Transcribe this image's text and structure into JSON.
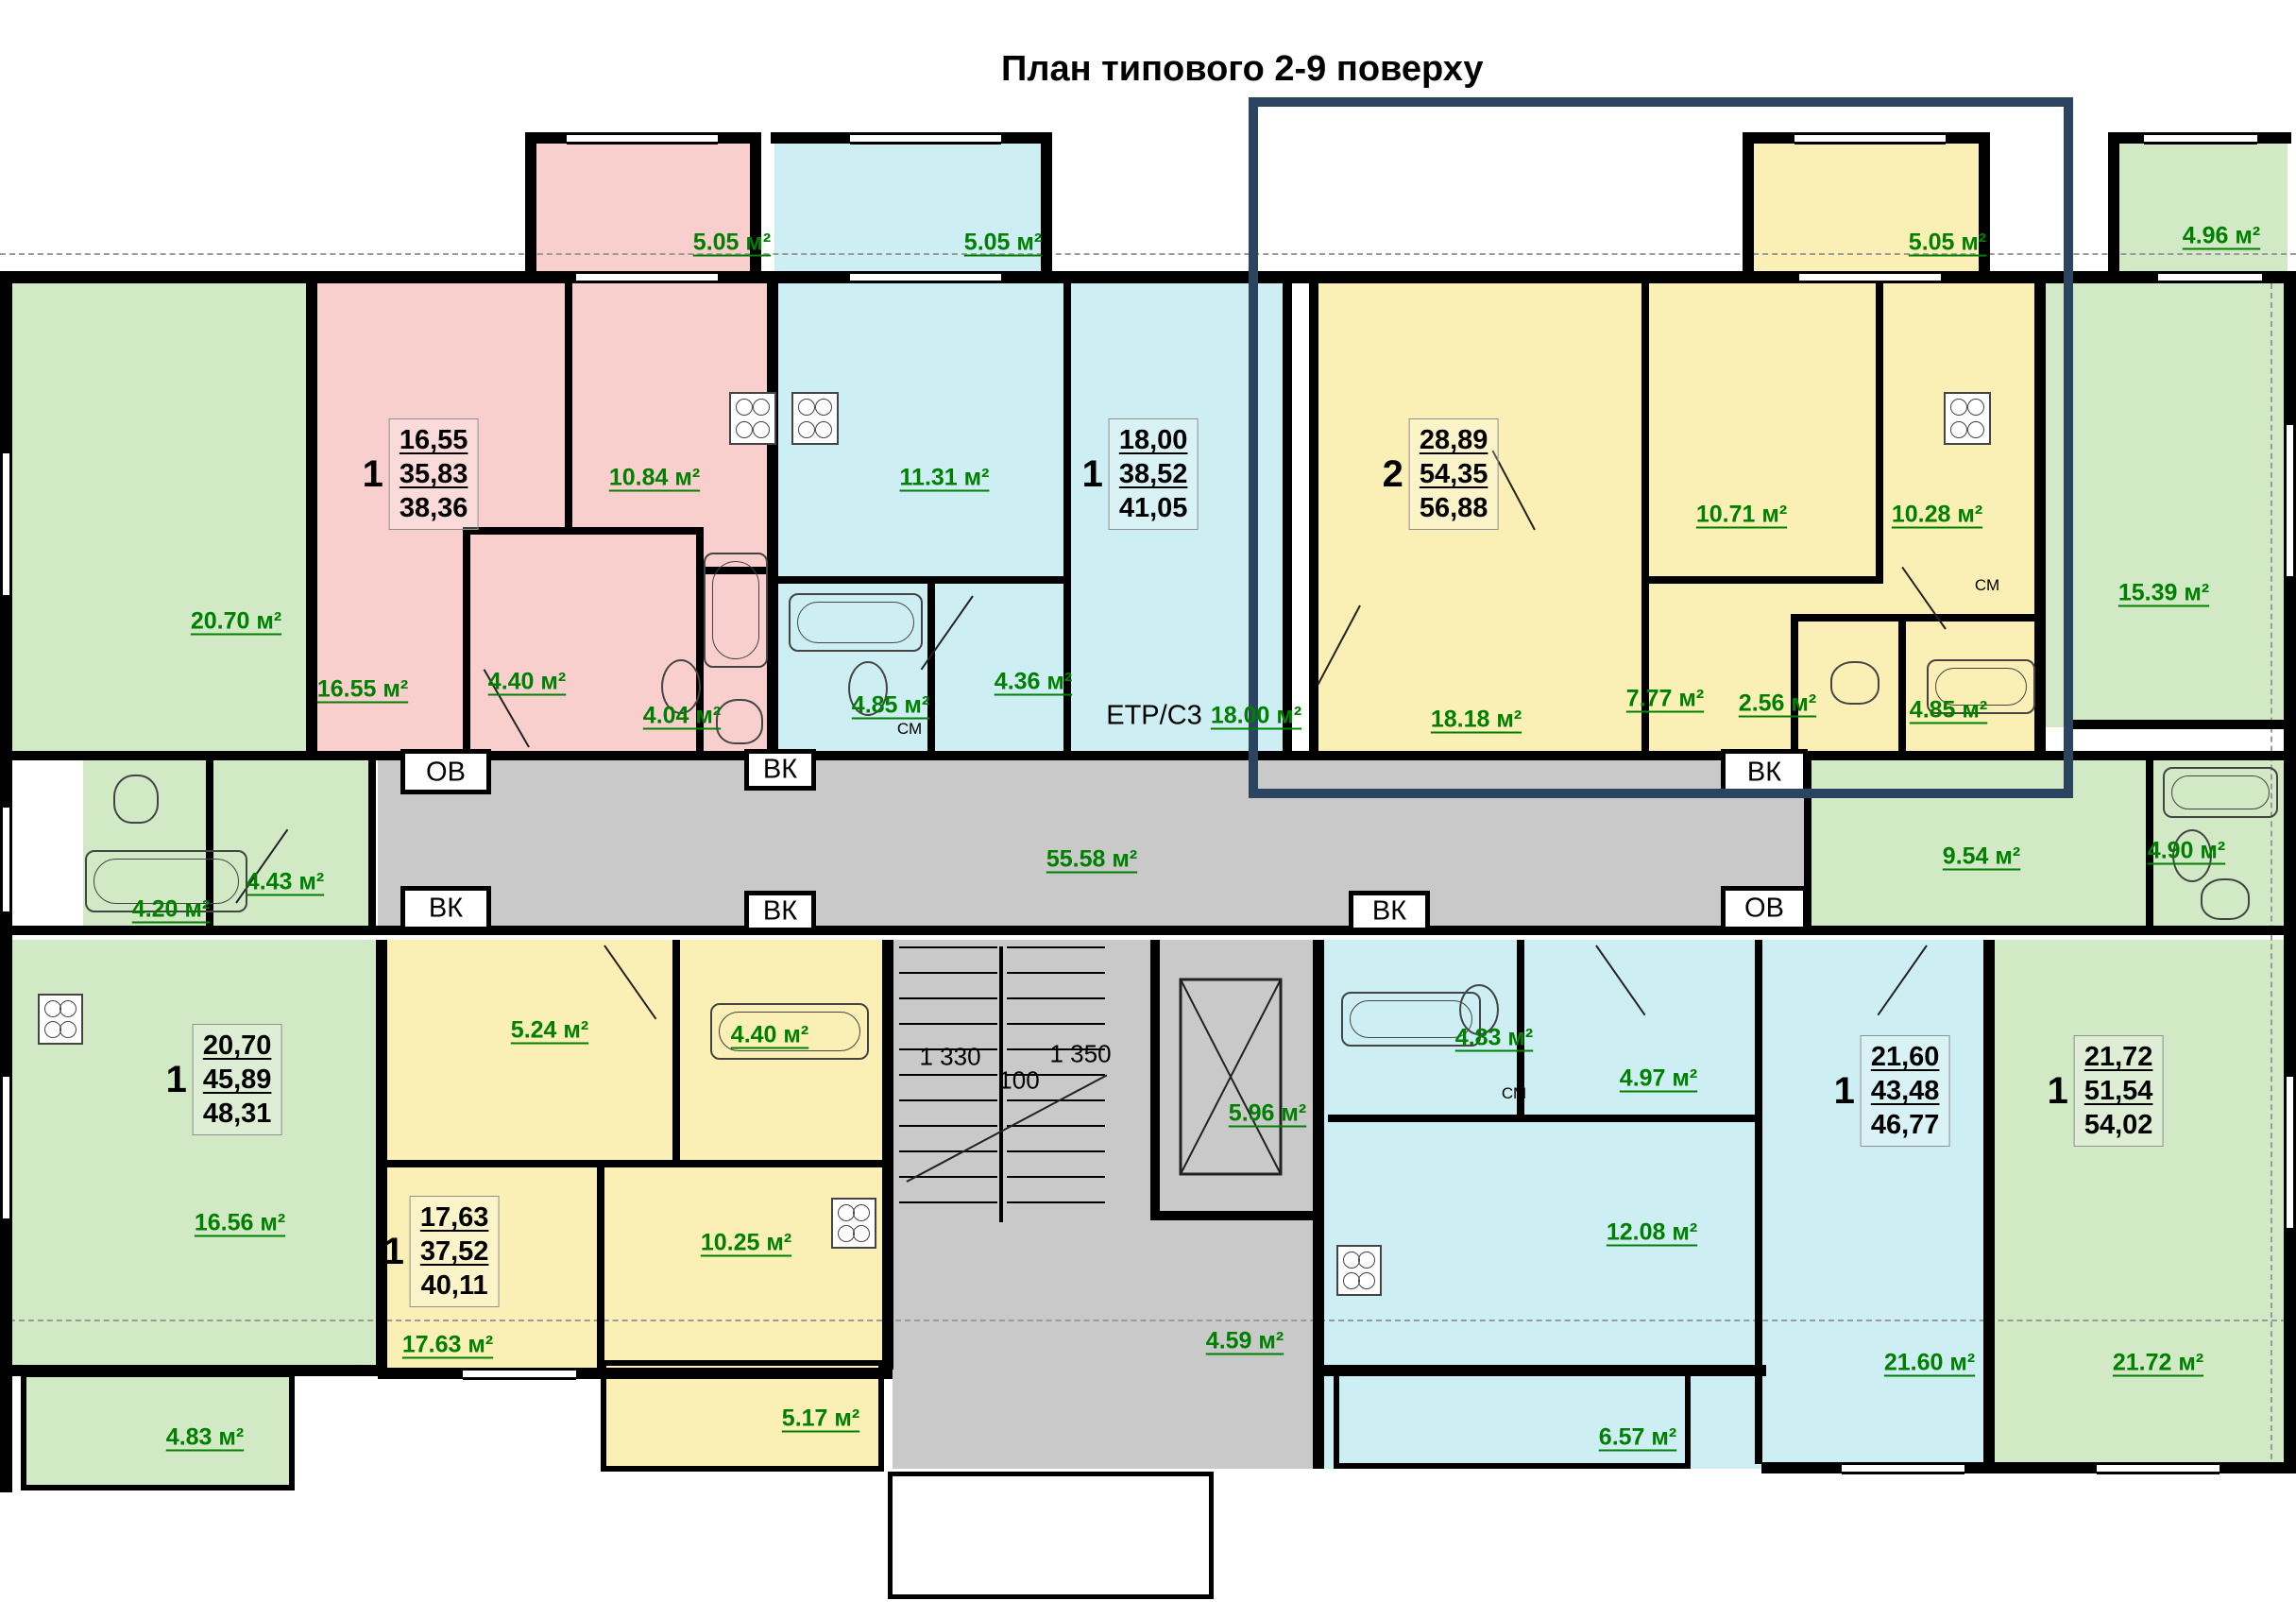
{
  "title": "План типового 2-9 поверху",
  "service": {
    "ov": "ОВ",
    "vk": "ВК",
    "sm": "СМ",
    "etr": "ЕТР/С3"
  },
  "dims": {
    "flight_left": "1 330",
    "flight_right": "1 350",
    "gap": "100"
  },
  "areas": {
    "balcony_pink": "5.05 м²",
    "balcony_blue": "5.05 м²",
    "balcony_yellow": "5.05 м²",
    "balcony_green": "4.96 м²",
    "green_tl_room": "20.70 м²",
    "pink_living": "16.55 м²",
    "pink_kitchen": "10.84 м²",
    "pink_hall": "4.40 м²",
    "pink_bath": "4.04 м²",
    "blue_kitchen": "11.31 м²",
    "blue_bath": "4.85 м²",
    "blue_hall": "4.36 м²",
    "blue_living": "18.00 м²",
    "yellow_living": "18.18 м²",
    "yellow_room2": "10.71 м²",
    "yellow_kitchen": "10.28 м²",
    "yellow_hall": "7.77 м²",
    "yellow_wc": "2.56 м²",
    "yellow_bath": "4.85 м²",
    "green_tr_room": "15.39 м²",
    "mid_left_bath": "4.20 м²",
    "mid_left_hall": "4.43 м²",
    "corridor": "55.58 м²",
    "mid_right_hall": "9.54 м²",
    "mid_right_bath": "4.90 м²",
    "bl_room": "16.56 м²",
    "bl_balcony": "4.83 м²",
    "yb_bedroom": "5.24 м²",
    "yb_bath": "4.40 м²",
    "yb_kitchen": "10.25 м²",
    "yb_living": "17.63 м²",
    "yb_balcony": "5.17 м²",
    "elevator": "5.96 м²",
    "vestibule": "4.59 м²",
    "bb_bath": "4.83 м²",
    "bb_hall": "4.97 м²",
    "bb_kitchen": "12.08 м²",
    "bb_living": "21.60 м²",
    "bb_balcony": "6.57 м²",
    "br_room": "21.72 м²"
  },
  "apartments": {
    "pink": {
      "rooms": "1",
      "living": "16,55",
      "total": "35,83",
      "full": "38,36"
    },
    "blue_top": {
      "rooms": "1",
      "living": "18,00",
      "total": "38,52",
      "full": "41,05"
    },
    "yellow_top": {
      "rooms": "2",
      "living": "28,89",
      "total": "54,35",
      "full": "56,88"
    },
    "green_bl": {
      "rooms": "1",
      "living": "20,70",
      "total": "45,89",
      "full": "48,31"
    },
    "yellow_bottom": {
      "rooms": "1",
      "living": "17,63",
      "total": "37,52",
      "full": "40,11"
    },
    "blue_bottom": {
      "rooms": "1",
      "living": "21,60",
      "total": "43,48",
      "full": "46,77"
    },
    "green_br": {
      "rooms": "1",
      "living": "21,72",
      "total": "51,54",
      "full": "54,02"
    }
  }
}
